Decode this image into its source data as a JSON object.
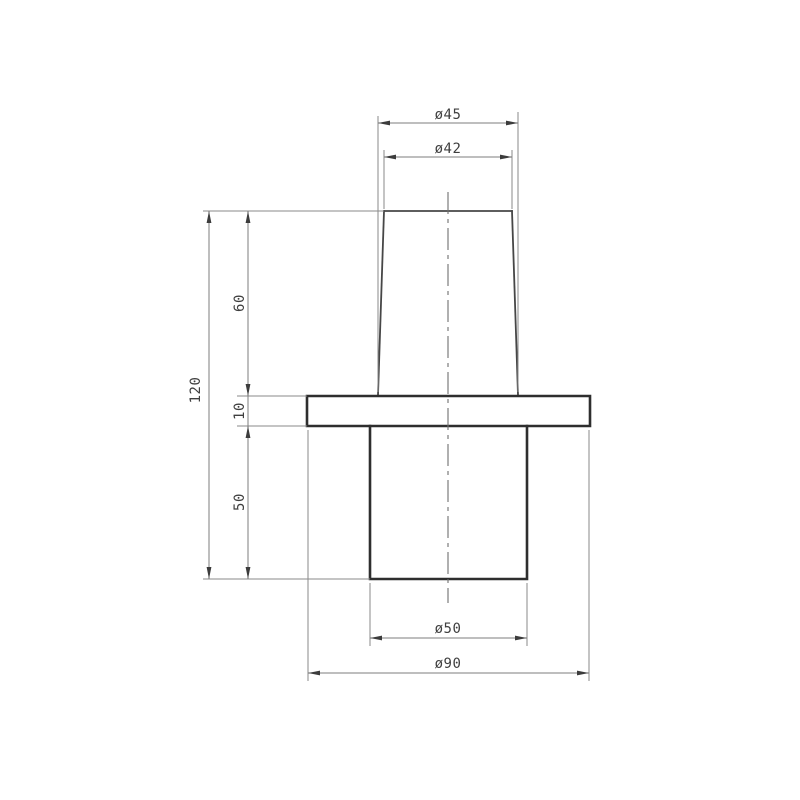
{
  "drawing": {
    "kind": "technical-dimension-drawing",
    "dimensions": {
      "top_outer_diameter": "ø45",
      "top_inner_diameter": "ø42",
      "total_height": "120",
      "upper_height": "60",
      "flange_thickness": "10",
      "lower_height": "50",
      "lower_diameter": "ø50",
      "flange_diameter": "ø90"
    },
    "colors": {
      "outline": "#2e2e2e",
      "cone_outline": "#474747",
      "thin_line": "#8a8a8a",
      "centerline": "#6f6f6f",
      "text": "#3f3f3f",
      "background": "#ffffff"
    }
  }
}
